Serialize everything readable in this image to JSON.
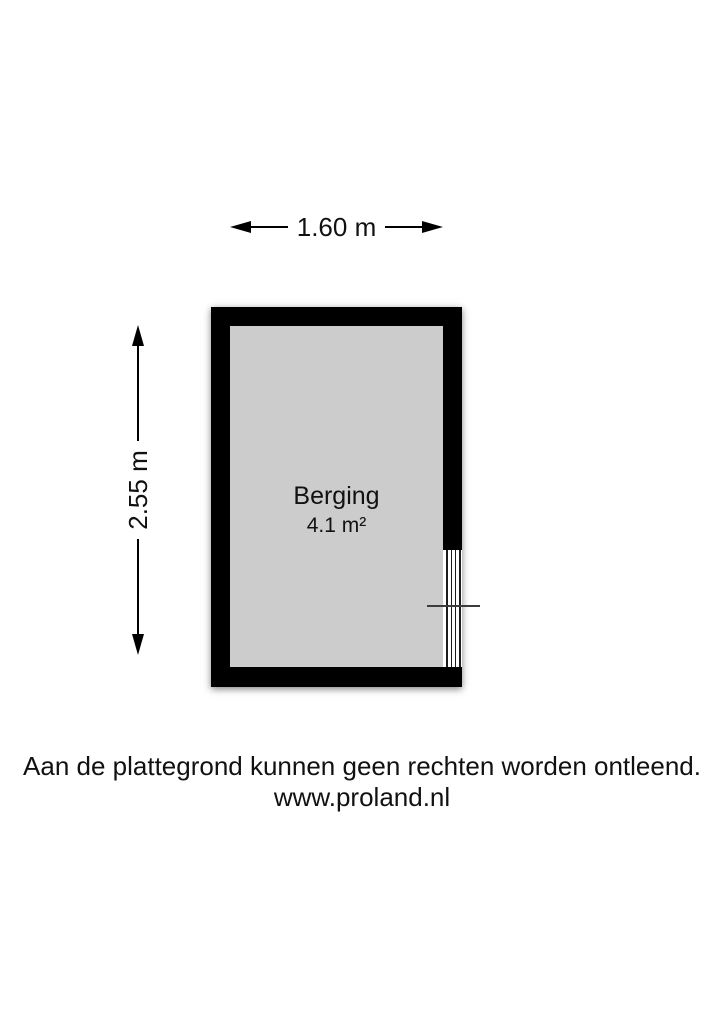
{
  "canvas": {
    "background": "#ffffff"
  },
  "dimensions": {
    "width": {
      "label": "1.60 m"
    },
    "height": {
      "label": "2.55 m"
    }
  },
  "room": {
    "name": "Berging",
    "area": "4.1 m²",
    "wall_color": "#000000",
    "floor_color": "#cccccc"
  },
  "footer": {
    "disclaimer": "Aan de plattegrond kunnen geen rechten worden ontleend.",
    "website": "www.proland.nl"
  }
}
